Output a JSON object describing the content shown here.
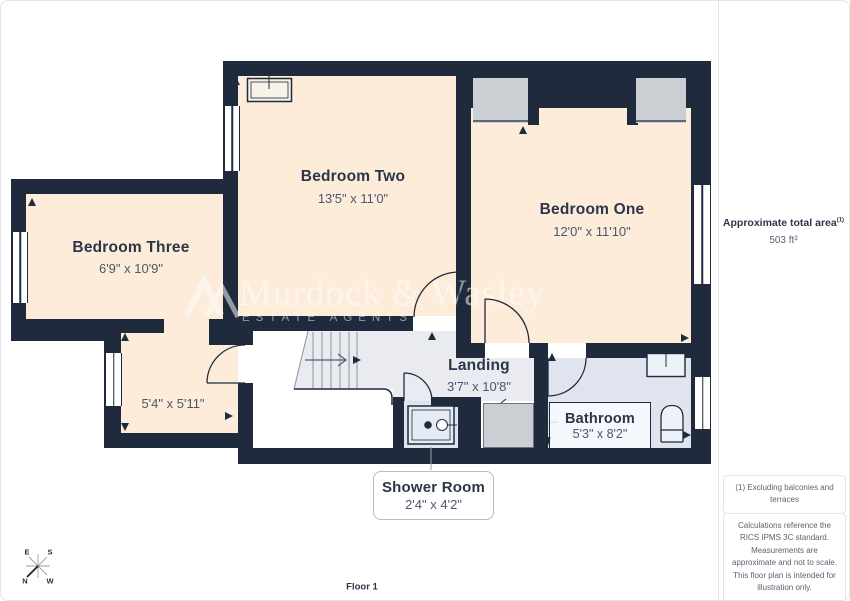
{
  "floorplan": {
    "floor_label": "Floor 1",
    "rooms": {
      "bedroom_two": {
        "name": "Bedroom Two",
        "dims": "13'5\" x 11'0\""
      },
      "bedroom_one": {
        "name": "Bedroom One",
        "dims": "12'0\" x 11'10\""
      },
      "bedroom_three": {
        "name": "Bedroom Three",
        "dims": "6'9\" x 10'9\""
      },
      "dressing_room": {
        "dims": "5'4\" x 5'11\""
      },
      "landing": {
        "name": "Landing",
        "dims": "3'7\" x 10'8\""
      },
      "bathroom": {
        "name": "Bathroom",
        "dims": "5'3\" x 8'2\""
      },
      "shower_room": {
        "name": "Shower Room",
        "dims": "2'4\" x 4'2\""
      }
    },
    "compass": {
      "n": "N",
      "e": "E",
      "s": "S",
      "w": "W"
    },
    "watermark": {
      "name": "Murdock & Wasley",
      "tagline": "ESTATE AGENTS"
    }
  },
  "sidebar": {
    "area_label": "Approximate total area",
    "area_footnote_marker": "(1)",
    "area_value": "503 ft²",
    "footnote": "(1) Excluding balconies and terraces",
    "disclaimer": "Calculations reference the RICS IPMS 3C standard. Measurements are approximate and not to scale. This floor plan is intended for illustration only.",
    "brand_name": "GIRAFFE",
    "brand_suffix": "360"
  },
  "colors": {
    "wall": "#1f2b3d",
    "bedroom_fill": "#fcecd9",
    "landing_fill": "#e9ebf1",
    "bathroom_fill": "#dfe4ee",
    "cupboard_fill": "#cbced3",
    "room_name_text": "#2b3648",
    "dims_text": "#4a576d"
  }
}
